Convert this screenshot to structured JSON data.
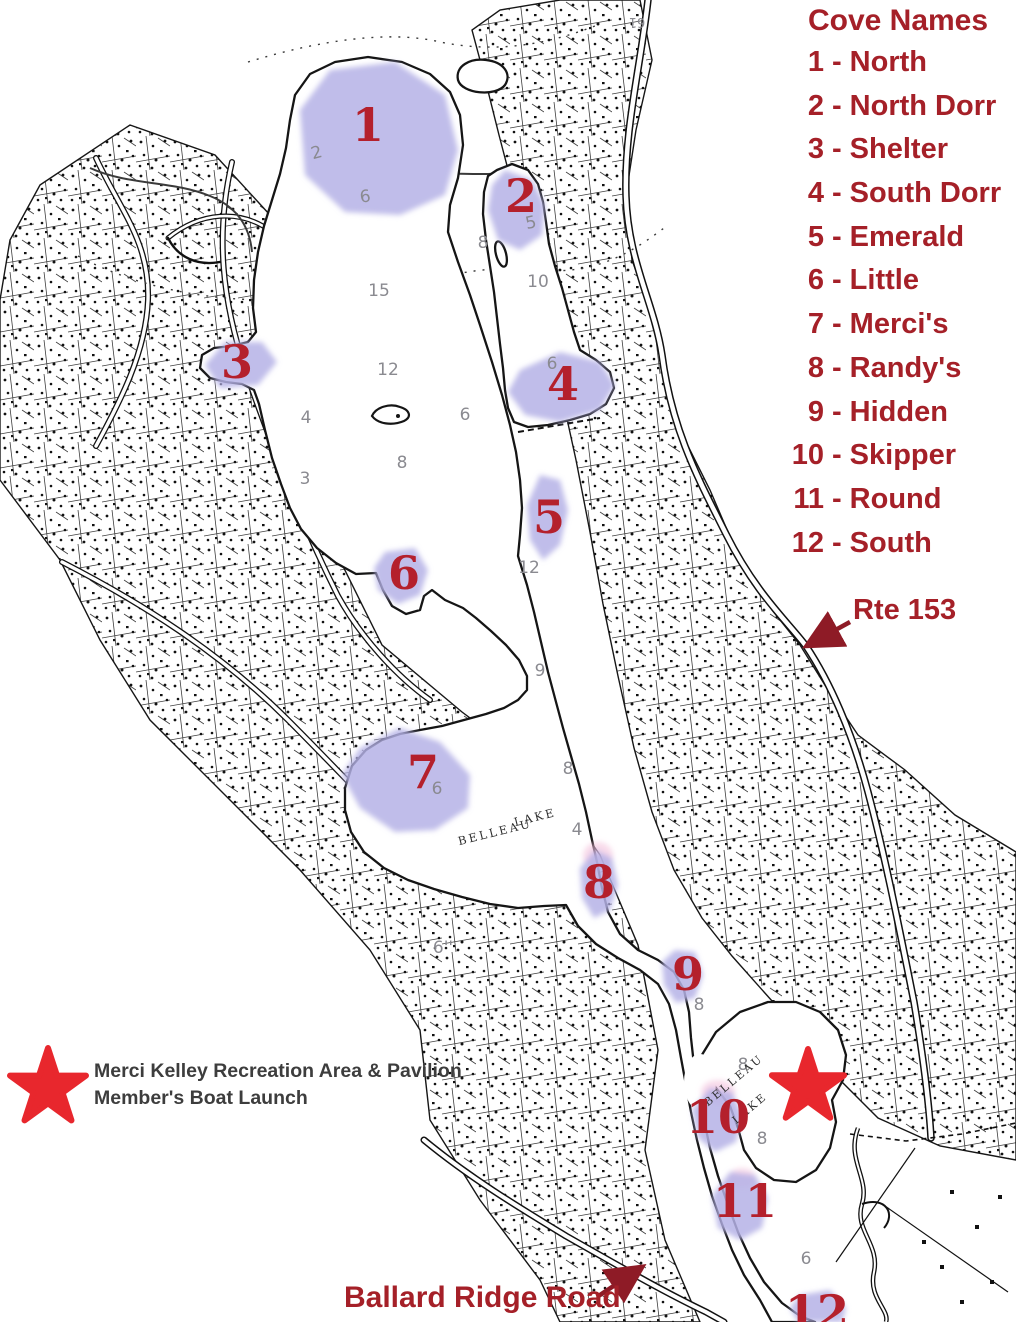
{
  "legend": {
    "title": "Cove Names",
    "entries": [
      {
        "num": "1",
        "name": "North"
      },
      {
        "num": "2",
        "name": "North Dorr"
      },
      {
        "num": "3",
        "name": "Shelter"
      },
      {
        "num": "4",
        "name": "South Dorr"
      },
      {
        "num": "5",
        "name": "Emerald"
      },
      {
        "num": "6",
        "name": "Little"
      },
      {
        "num": "7",
        "name": "Merci's"
      },
      {
        "num": "8",
        "name": "Randy's"
      },
      {
        "num": "9",
        "name": "Hidden"
      },
      {
        "num": "10",
        "name": "Skipper"
      },
      {
        "num": "11",
        "name": "Round"
      },
      {
        "num": "12",
        "name": "South"
      }
    ]
  },
  "annotations": {
    "rte_153": "Rte 153",
    "ballard": "Ballard Ridge Road",
    "star_line1": "Merci Kelley Recreation Area & Pavilion",
    "star_line2": "Member's Boat Launch"
  },
  "colors": {
    "legend_red": "#a52028",
    "cove_number_red": "#b4202c",
    "star_red": "#e8272d",
    "arrow_red": "#8e1b26",
    "cove_fill": "#b5b2e6",
    "cove_pink": "#f3bcd8",
    "depth_gray": "#8a8a90",
    "lake_label_color": "#2e2e2e"
  },
  "cove_markers": [
    {
      "n": "1",
      "x": 368,
      "y": 125
    },
    {
      "n": "2",
      "x": 521,
      "y": 196
    },
    {
      "n": "3",
      "x": 237,
      "y": 362
    },
    {
      "n": "4",
      "x": 563,
      "y": 384
    },
    {
      "n": "5",
      "x": 549,
      "y": 517
    },
    {
      "n": "6",
      "x": 404,
      "y": 573
    },
    {
      "n": "7",
      "x": 423,
      "y": 772
    },
    {
      "n": "8",
      "x": 599,
      "y": 882
    },
    {
      "n": "9",
      "x": 688,
      "y": 974
    },
    {
      "n": "10",
      "x": 718,
      "y": 1117
    },
    {
      "n": "11",
      "x": 745,
      "y": 1201
    },
    {
      "n": "12",
      "x": 817,
      "y": 1312
    }
  ],
  "depth_numbers": [
    {
      "t": "2",
      "x": 318,
      "y": 152,
      "r": -15
    },
    {
      "t": "6",
      "x": 366,
      "y": 196,
      "r": -8
    },
    {
      "t": "15",
      "x": 379,
      "y": 290
    },
    {
      "t": "8",
      "x": 483,
      "y": 242
    },
    {
      "t": "5",
      "x": 532,
      "y": 222,
      "r": -12
    },
    {
      "t": "10",
      "x": 538,
      "y": 281
    },
    {
      "t": "12",
      "x": 388,
      "y": 369
    },
    {
      "t": "4",
      "x": 306,
      "y": 417
    },
    {
      "t": "6",
      "x": 465,
      "y": 414
    },
    {
      "t": "8",
      "x": 402,
      "y": 462
    },
    {
      "t": "3",
      "x": 305,
      "y": 478
    },
    {
      "t": "6",
      "x": 552,
      "y": 363
    },
    {
      "t": "12",
      "x": 529,
      "y": 567
    },
    {
      "t": "9",
      "x": 540,
      "y": 670
    },
    {
      "t": "8",
      "x": 568,
      "y": 768
    },
    {
      "t": "4",
      "x": 577,
      "y": 829
    },
    {
      "t": "6",
      "x": 437,
      "y": 788
    },
    {
      "t": "8",
      "x": 699,
      "y": 1004
    },
    {
      "t": "8",
      "x": 743,
      "y": 1064
    },
    {
      "t": "8",
      "x": 762,
      "y": 1138
    },
    {
      "t": "6",
      "x": 806,
      "y": 1258
    },
    {
      "t": "6''",
      "x": 443,
      "y": 947
    },
    {
      "t": "61",
      "x": 637,
      "y": 12,
      "r": 180,
      "s": 13
    }
  ],
  "lake_labels": [
    {
      "t": "BELLEAU",
      "x": 496,
      "y": 836,
      "r": -14,
      "s": 11.5
    },
    {
      "t": "LAKE",
      "x": 536,
      "y": 821,
      "r": -14,
      "s": 11.5
    },
    {
      "t": "BELLEAU",
      "x": 736,
      "y": 1083,
      "r": -40,
      "s": 11
    },
    {
      "t": "LAKE",
      "x": 752,
      "y": 1111,
      "r": -40,
      "s": 11
    }
  ]
}
